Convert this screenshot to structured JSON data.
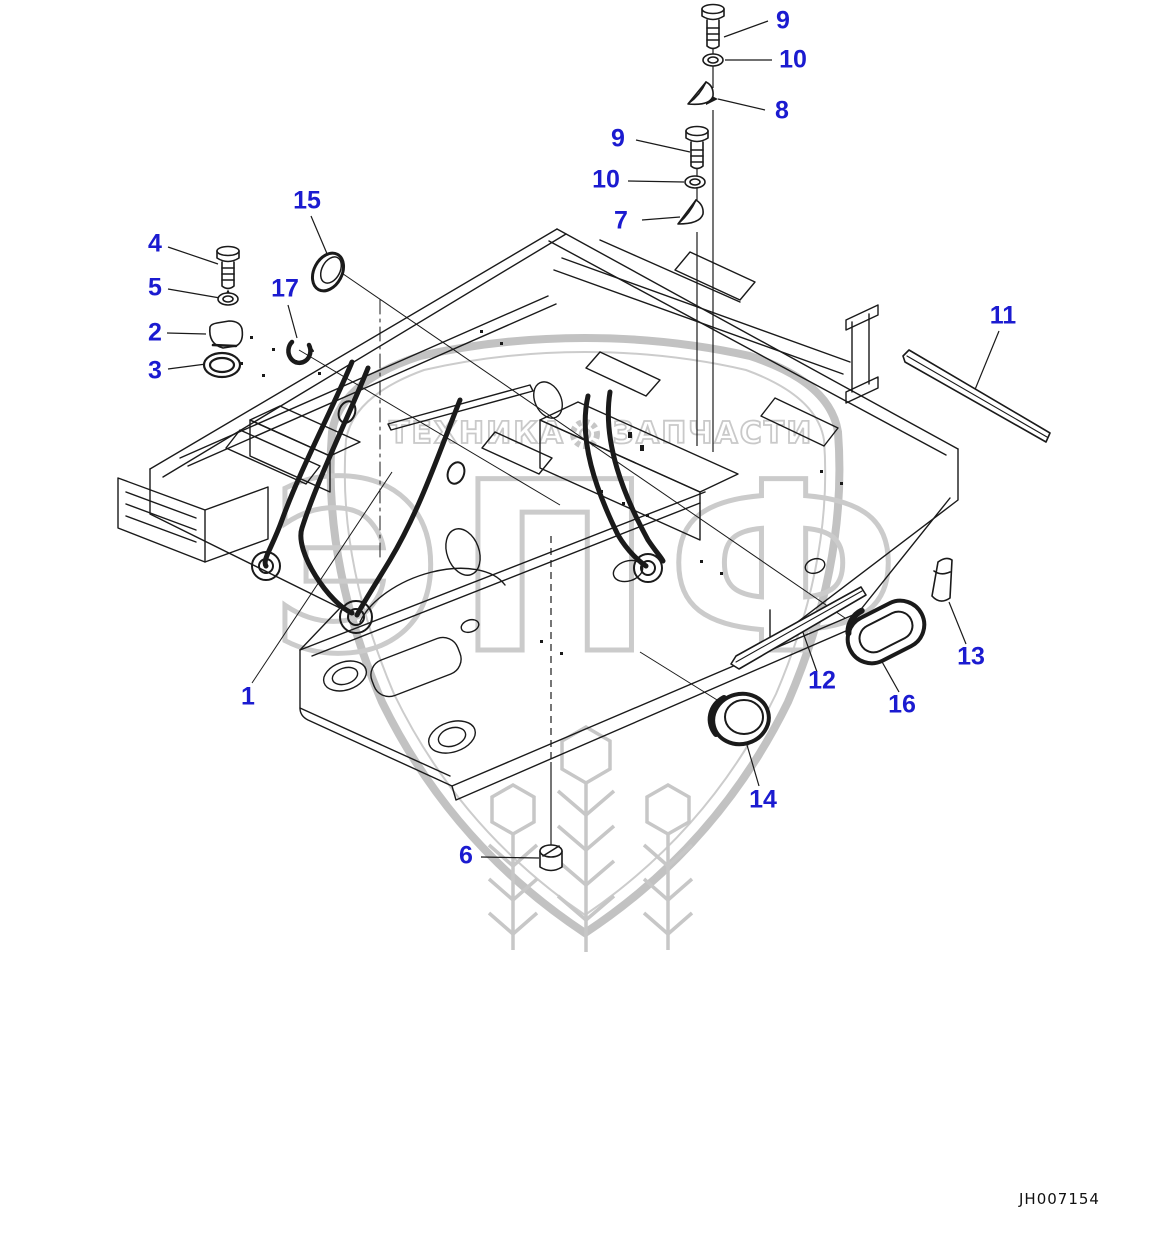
{
  "diagram": {
    "code": "JH007154",
    "watermark": {
      "left_text": "ТЕХНИКА",
      "right_text": "ЗАПЧАСТИ",
      "monogram": "ЭПФ"
    }
  },
  "colors": {
    "callout_blue": "#1b1bd0",
    "line_black": "#1a1a1a",
    "watermark_gray": "#c6c6c6"
  },
  "callouts": [
    {
      "label": "1"
    },
    {
      "label": "2"
    },
    {
      "label": "3"
    },
    {
      "label": "4"
    },
    {
      "label": "5"
    },
    {
      "label": "6"
    },
    {
      "label": "7"
    },
    {
      "label": "8"
    },
    {
      "label": "9"
    },
    {
      "label": "10"
    },
    {
      "label": "9"
    },
    {
      "label": "10"
    },
    {
      "label": "11"
    },
    {
      "label": "12"
    },
    {
      "label": "13"
    },
    {
      "label": "14"
    },
    {
      "label": "15"
    },
    {
      "label": "16"
    },
    {
      "label": "17"
    }
  ]
}
